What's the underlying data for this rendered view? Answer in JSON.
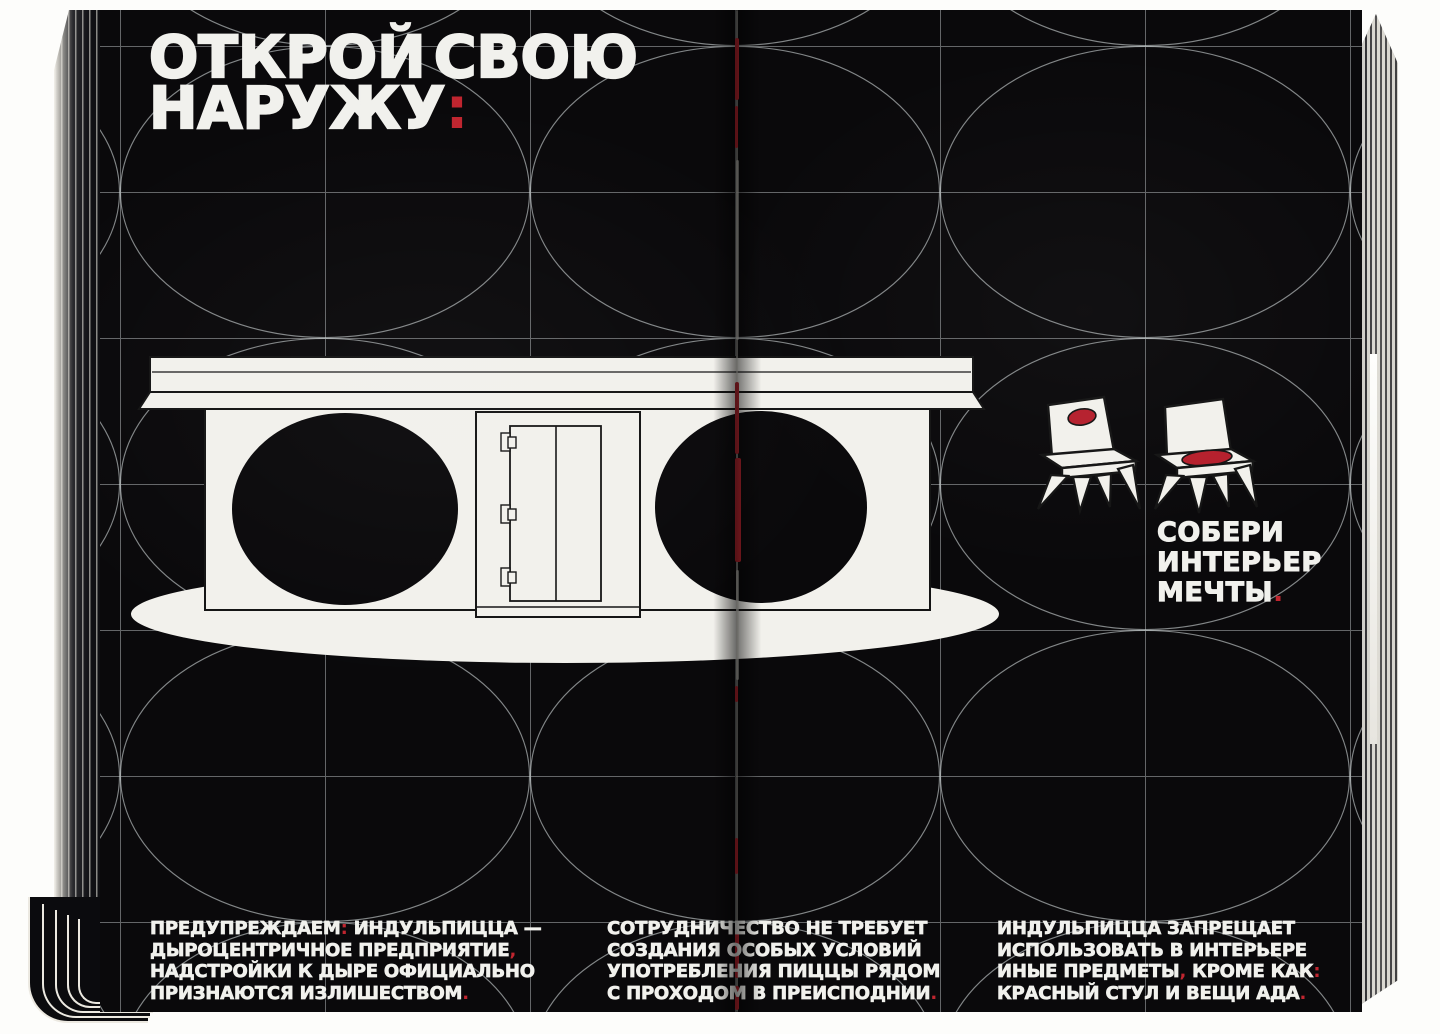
{
  "palette": {
    "page_black": "#0a090b",
    "paper_white": "#f2f1ec",
    "accent_red": "#c0252f",
    "grid_line": "#d2d8da"
  },
  "headline": {
    "lines": [
      [
        {
          "t": "ОТКРОЙ СВОЮ",
          "c": "w"
        }
      ],
      [
        {
          "t": "НАРУЖУ",
          "c": "w"
        },
        {
          "t": ":",
          "c": "r"
        }
      ]
    ]
  },
  "interior_note": {
    "lines": [
      [
        {
          "t": "СОБЕРИ",
          "c": "w"
        }
      ],
      [
        {
          "t": "ИНТЕРЬЕР",
          "c": "w"
        }
      ],
      [
        {
          "t": "МЕЧТЫ",
          "c": "w"
        },
        {
          "t": ".",
          "c": "r"
        }
      ]
    ]
  },
  "footnotes": [
    {
      "lines": [
        [
          {
            "t": "ПРЕДУПРЕЖДАЕМ",
            "c": "w"
          },
          {
            "t": ":",
            "c": "r"
          },
          {
            "t": " ИНДУЛЬПИЦЦА —",
            "c": "w"
          }
        ],
        [
          {
            "t": "ДЫРОЦЕНТРИЧНОЕ ПРЕДПРИЯТИЕ",
            "c": "w"
          },
          {
            "t": ",",
            "c": "r"
          }
        ],
        [
          {
            "t": "НАДСТРОЙКИ К ДЫРЕ ОФИЦИАЛЬНО",
            "c": "w"
          }
        ],
        [
          {
            "t": "ПРИЗНАЮТСЯ ИЗЛИШЕСТВОМ",
            "c": "w"
          },
          {
            "t": ".",
            "c": "r"
          }
        ]
      ]
    },
    {
      "lines": [
        [
          {
            "t": "СОТРУДНИЧЕСТВО НЕ ТРЕБУЕТ",
            "c": "w"
          }
        ],
        [
          {
            "t": "СОЗДАНИЯ ОСОБЫХ УСЛОВИЙ",
            "c": "w"
          }
        ],
        [
          {
            "t": "УПОТРЕБЛЕНИЯ ПИЦЦЫ РЯДОМ",
            "c": "w"
          }
        ],
        [
          {
            "t": "С ПРОХОДОМ В ПРЕИСПОДНИИ",
            "c": "w"
          },
          {
            "t": ".",
            "c": "r"
          }
        ]
      ]
    },
    {
      "lines": [
        [
          {
            "t": "ИНДУЛЬПИЦЦА ЗАПРЕЩАЕТ",
            "c": "w"
          }
        ],
        [
          {
            "t": "ИСПОЛЬЗОВАТЬ В ИНТЕРЬЕРЕ",
            "c": "w"
          }
        ],
        [
          {
            "t": "ИНЫЕ ПРЕДМЕТЫ",
            "c": "w"
          },
          {
            "t": ",",
            "c": "r"
          },
          {
            "t": " КРОМЕ КАК",
            "c": "w"
          },
          {
            "t": ":",
            "c": "r"
          }
        ],
        [
          {
            "t": "КРАСНЫЙ СТУЛ И ВЕЩИ АДА",
            "c": "w"
          },
          {
            "t": ".",
            "c": "r"
          }
        ]
      ]
    }
  ],
  "figures": {
    "counter": "counter-with-two-black-holes-and-furnace-door",
    "chair_left": "spiky-chair-red-dot-on-backrest",
    "chair_right": "spiky-chair-red-dot-on-seat",
    "background": "ellipse-grid-pattern",
    "spine": "book-fold-with-red-stitching"
  }
}
